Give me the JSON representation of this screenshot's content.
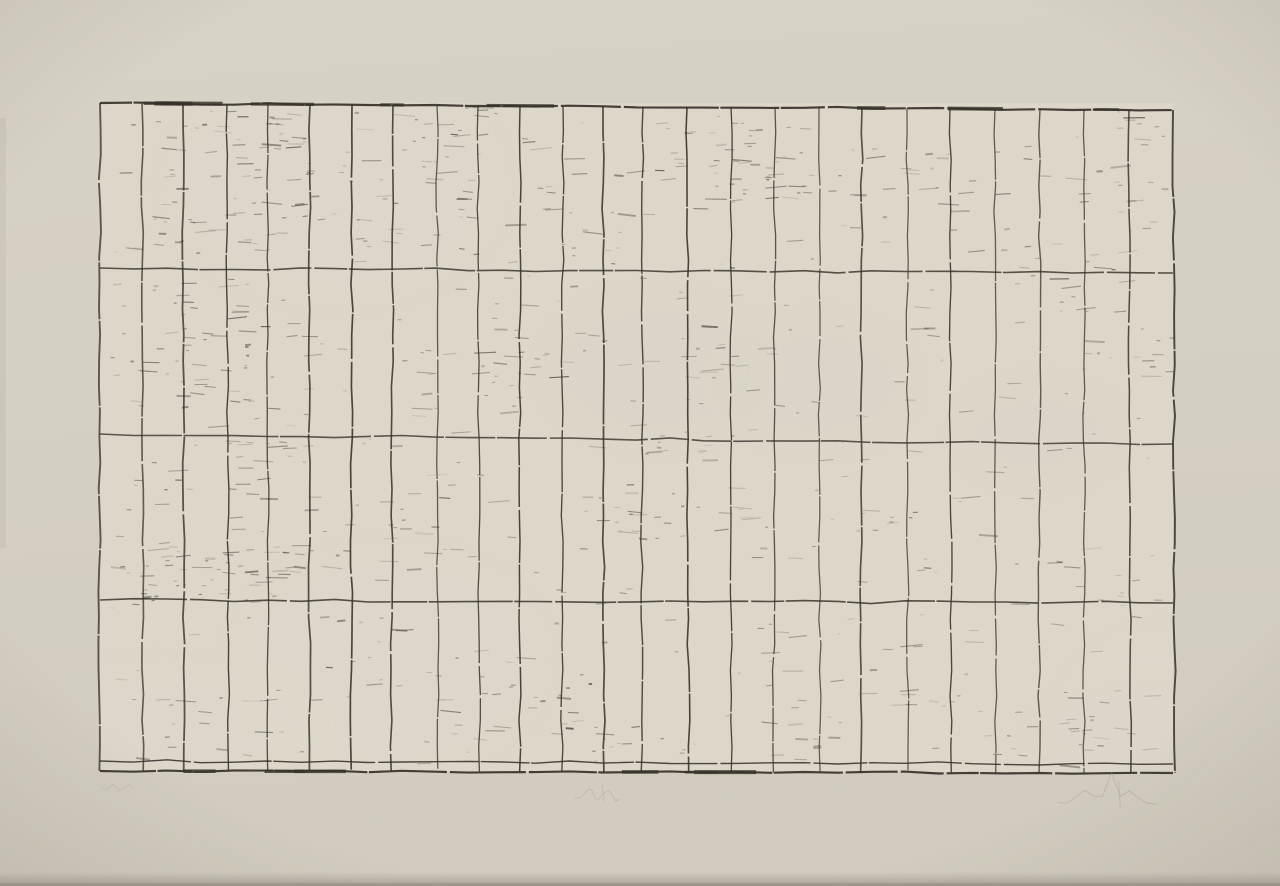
{
  "artwork": {
    "kind": "etching-grid-print-on-cream-paper",
    "canvas": {
      "width": 1280,
      "height": 886
    },
    "colors": {
      "paper_top": "#d7d2c6",
      "paper_mid": "#d4cfc3",
      "paper_bottom": "#d1ccbf",
      "plate": "#dcd7c9",
      "plate_light": "#e1dccd",
      "plate_dark": "#d5d0c2",
      "ink": "#35322a",
      "pencil": "#9b9587",
      "bottom_shadow": "#8f8a7d",
      "vignette": "#5f5a4c"
    },
    "plate": {
      "left": 100,
      "top": 103,
      "right": 1173,
      "bottom": 772
    },
    "grid": {
      "seed": 1372,
      "column_lines": [
        100,
        142,
        183,
        227,
        268,
        310,
        352,
        393,
        437,
        478,
        520,
        563,
        603,
        643,
        687,
        731,
        775,
        819,
        862,
        907,
        950,
        995,
        1040,
        1084,
        1129,
        1173
      ],
      "row_lines": [
        [
          103,
          110
        ],
        [
          268,
          273
        ],
        [
          434,
          444
        ],
        [
          600,
          603
        ],
        [
          761,
          764
        ],
        [
          771,
          773
        ]
      ],
      "columns": 25,
      "rows": 4,
      "narrow_bottom_band": true
    },
    "texture": {
      "global_fleck_count": 320,
      "clusters": [
        [
          150,
          108,
          160,
          145,
          70
        ],
        [
          300,
          160,
          85,
          60,
          14
        ],
        [
          360,
          105,
          120,
          150,
          40
        ],
        [
          540,
          150,
          80,
          115,
          16
        ],
        [
          655,
          115,
          150,
          95,
          34
        ],
        [
          700,
          148,
          230,
          55,
          26
        ],
        [
          930,
          140,
          95,
          130,
          14
        ],
        [
          1075,
          110,
          95,
          160,
          22
        ],
        [
          110,
          278,
          200,
          130,
          55
        ],
        [
          390,
          325,
          145,
          85,
          16
        ],
        [
          490,
          295,
          70,
          95,
          12
        ],
        [
          695,
          342,
          80,
          30,
          7
        ],
        [
          1010,
          273,
          110,
          40,
          9
        ],
        [
          1120,
          300,
          50,
          90,
          8
        ],
        [
          125,
          440,
          190,
          165,
          60
        ],
        [
          375,
          487,
          80,
          65,
          10
        ],
        [
          580,
          492,
          175,
          48,
          26
        ],
        [
          845,
          508,
          80,
          32,
          7
        ],
        [
          1040,
          555,
          140,
          45,
          12
        ],
        [
          110,
          545,
          190,
          60,
          22
        ],
        [
          640,
          430,
          80,
          40,
          8
        ],
        [
          425,
          655,
          165,
          85,
          30
        ],
        [
          585,
          725,
          100,
          45,
          10
        ],
        [
          745,
          720,
          80,
          35,
          7
        ],
        [
          985,
          685,
          100,
          85,
          12
        ],
        [
          135,
          695,
          130,
          85,
          12
        ],
        [
          300,
          610,
          100,
          60,
          8
        ],
        [
          860,
          640,
          120,
          80,
          10
        ],
        [
          1060,
          690,
          100,
          70,
          10
        ]
      ]
    },
    "inscriptions": [
      {
        "id": "edition-mark",
        "legible": false,
        "x": 102,
        "y": 782,
        "w": 30,
        "h": 10,
        "opacity": 0.22,
        "ascender": false
      },
      {
        "id": "title-mark",
        "legible": false,
        "x": 575,
        "y": 783,
        "w": 44,
        "h": 20,
        "opacity": 0.3,
        "ascender": false
      },
      {
        "id": "signature-mark",
        "legible": false,
        "x": 1058,
        "y": 780,
        "w": 98,
        "h": 30,
        "opacity": 0.34,
        "ascender": true
      }
    ]
  }
}
